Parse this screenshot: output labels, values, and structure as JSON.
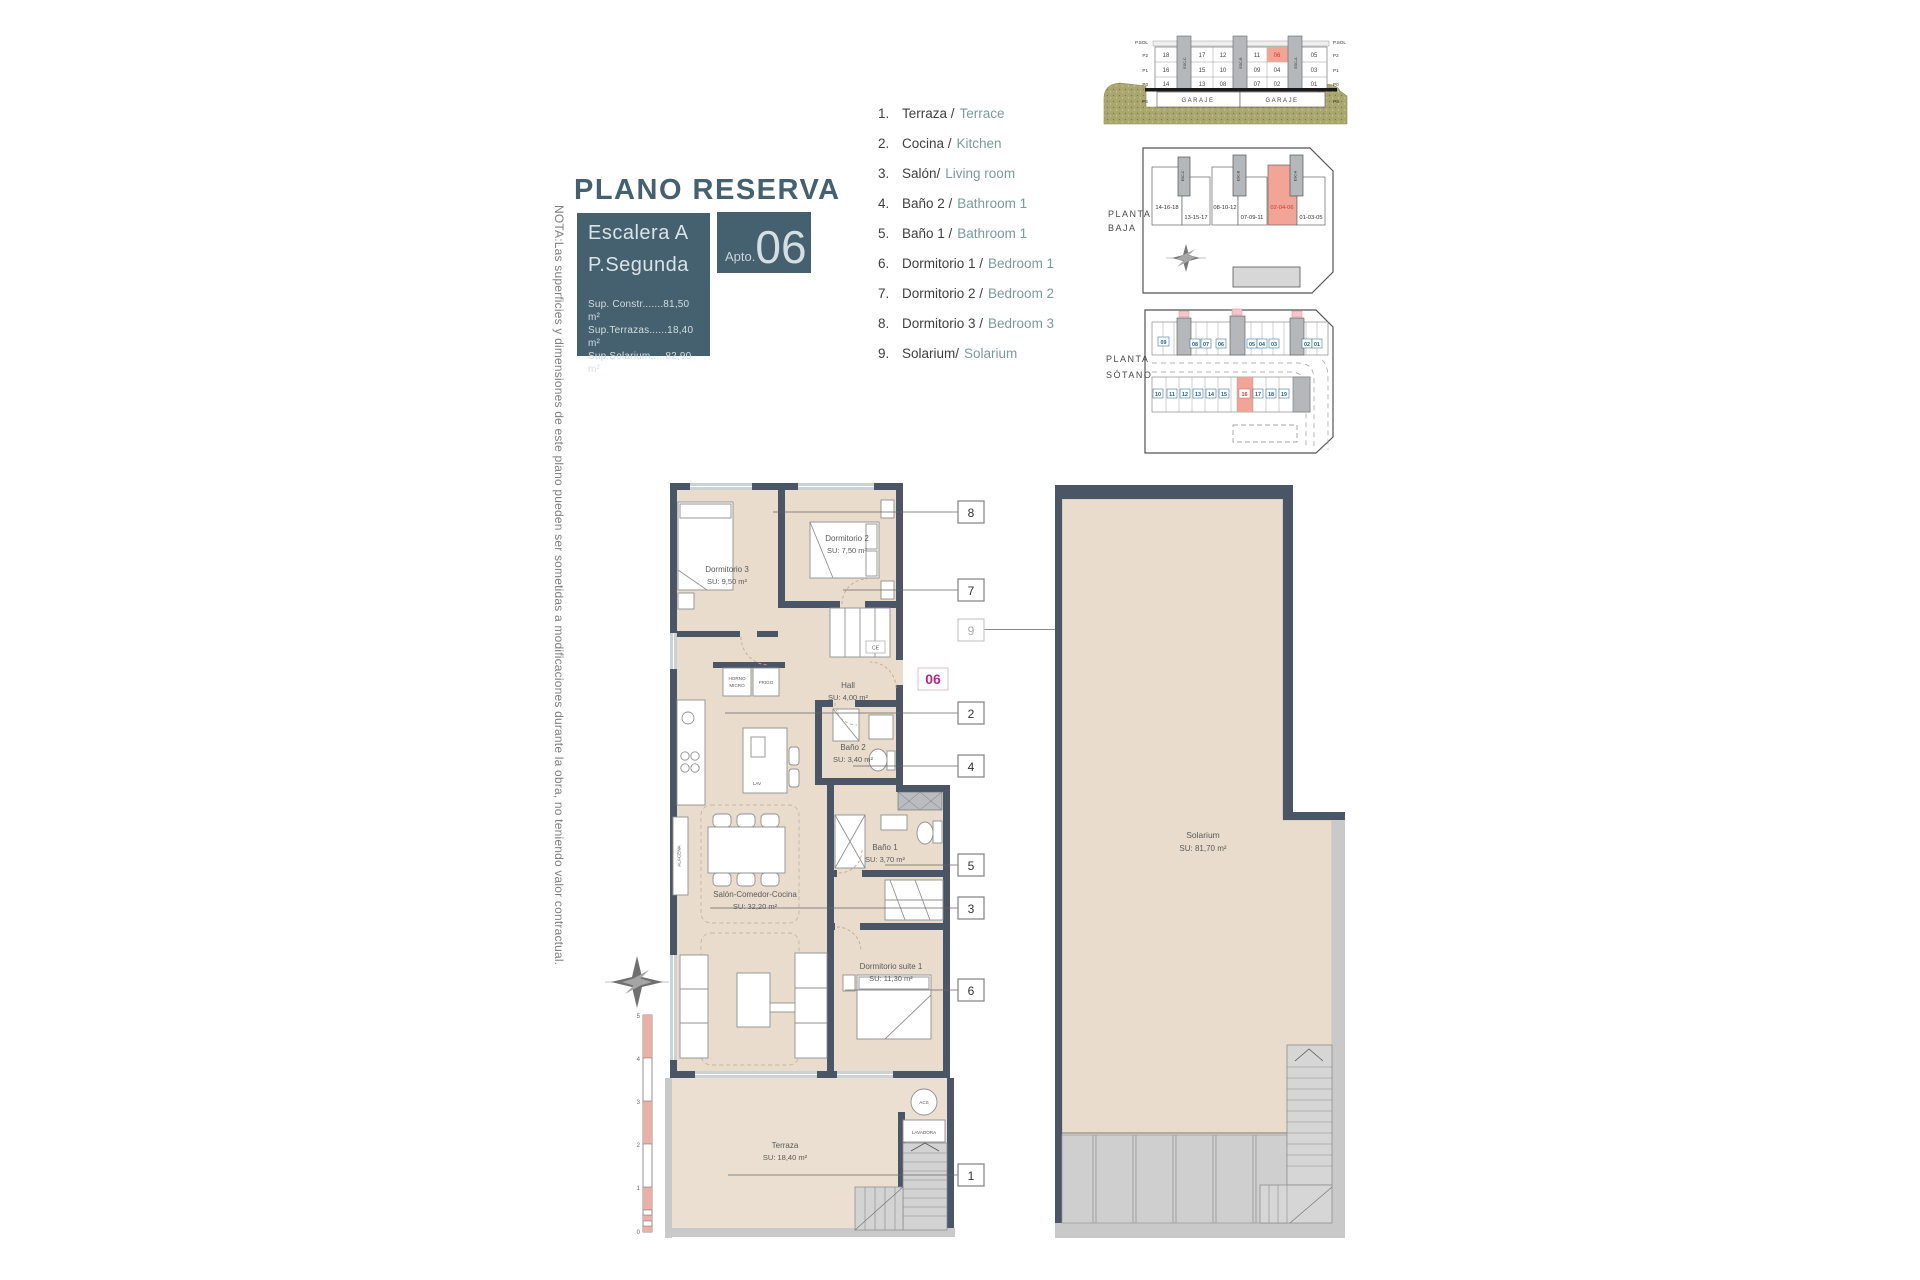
{
  "note": "NOTA:Las superficies y dimensiones de este plano pueden ser sometidas a modificaciones durante la obra, no teniendo valor contractual.",
  "title": "PLANO RESERVA",
  "title_block": {
    "escalera": "Escalera A",
    "planta": "P.Segunda",
    "sup_constr": "Sup. Constr.......81,50 m²",
    "sup_terrazas": "Sup.Terrazas......18,40 m²",
    "sup_solarium": "Sup.Solarium.....82,90 m²",
    "apto_label": "Apto.",
    "apto_number": "06"
  },
  "legend": {
    "items": [
      {
        "n": "1.",
        "es": "Terraza /",
        "en": "Terrace"
      },
      {
        "n": "2.",
        "es": "Cocina /",
        "en": "Kitchen"
      },
      {
        "n": "3.",
        "es": "Salón/",
        "en": "Living room"
      },
      {
        "n": "4.",
        "es": "Baño 2 /",
        "en": "Bathroom 1"
      },
      {
        "n": "5.",
        "es": "Baño 1 /",
        "en": "Bathroom 1"
      },
      {
        "n": "6.",
        "es": "Dormitorio 1 /",
        "en": "Bedroom 1"
      },
      {
        "n": "7.",
        "es": "Dormitorio 2 /",
        "en": "Bedroom 2"
      },
      {
        "n": "8.",
        "es": "Dormitorio 3 /",
        "en": "Bedroom 3"
      },
      {
        "n": "9.",
        "es": "Solarium/",
        "en": "Solarium"
      }
    ]
  },
  "section": {
    "floors": [
      "P.SOL",
      "P2",
      "P1",
      "P0",
      "PS"
    ],
    "row_p2": [
      "18",
      "17",
      "12",
      "11",
      "06",
      "05"
    ],
    "row_p1": [
      "16",
      "15",
      "10",
      "09",
      "04",
      "03"
    ],
    "row_p0": [
      "14",
      "13",
      "08",
      "07",
      "02",
      "01"
    ],
    "garaje": [
      "GARAJE",
      "GARAJE"
    ],
    "cores": [
      "ESC-C",
      "ESC-B",
      "ESC-A"
    ]
  },
  "planta_baja": {
    "label1": "PLANTA",
    "label2": "BAJA",
    "blocks": [
      "14-16-18",
      "13-15-17",
      "08-10-12",
      "07-09-11",
      "02-04-06",
      "01-03-05"
    ]
  },
  "planta_sotano": {
    "label1": "PLANTA",
    "label2": "SÓTANO",
    "storage": [
      "09",
      "08",
      "07",
      "06",
      "05",
      "04",
      "03",
      "02",
      "01"
    ],
    "parking": [
      "10",
      "11",
      "12",
      "13",
      "14",
      "15",
      "16",
      "17",
      "18",
      "19"
    ]
  },
  "plan": {
    "unit_tag": "06",
    "dorm3_name": "Dormitorio 3",
    "dorm3_area": "SU: 9,50 m²",
    "dorm2_name": "Dormitorio 2",
    "dorm2_area": "SU: 7,50 m²",
    "hall_name": "Hall",
    "hall_area": "SU: 4,00 m²",
    "bano2_name": "Baño 2",
    "bano2_area": "SU: 3,40 m²",
    "bano1_name": "Baño 1",
    "bano1_area": "SU: 3,70 m²",
    "salon_name": "Salón-Comedor-Cocina",
    "salon_area": "SU: 32,20 m²",
    "suite_name": "Dormitorio suite 1",
    "suite_area": "SU: 11,30 m²",
    "terraza_name": "Terraza",
    "terraza_area": "SU: 18,40 m²",
    "horno_l1": "HORNO",
    "horno_l2": "MICRO",
    "frigo": "FRIGO",
    "lav": "LAV",
    "alacena": "ALACENA",
    "ce": "CE",
    "acs": "ACS",
    "lavadora": "LAVADORA",
    "callouts": [
      "8",
      "7",
      "9",
      "2",
      "4",
      "5",
      "3",
      "6",
      "1"
    ],
    "scale_labels": [
      "5",
      "4",
      "3",
      "2",
      "1",
      "0"
    ]
  },
  "solarium": {
    "name": "Solarium",
    "area": "SU: 81,70 m²"
  },
  "colors": {
    "teal": "#45606e",
    "wall": "#4a5566",
    "floor": "#e9dccc",
    "highlight": "#f2a496",
    "highlight_text": "#cc3a2c",
    "magenta": "#b02a8c",
    "legend_en": "#7d9a99",
    "ground": "#aaa76e",
    "blue_tag": "#1d5e8f"
  }
}
